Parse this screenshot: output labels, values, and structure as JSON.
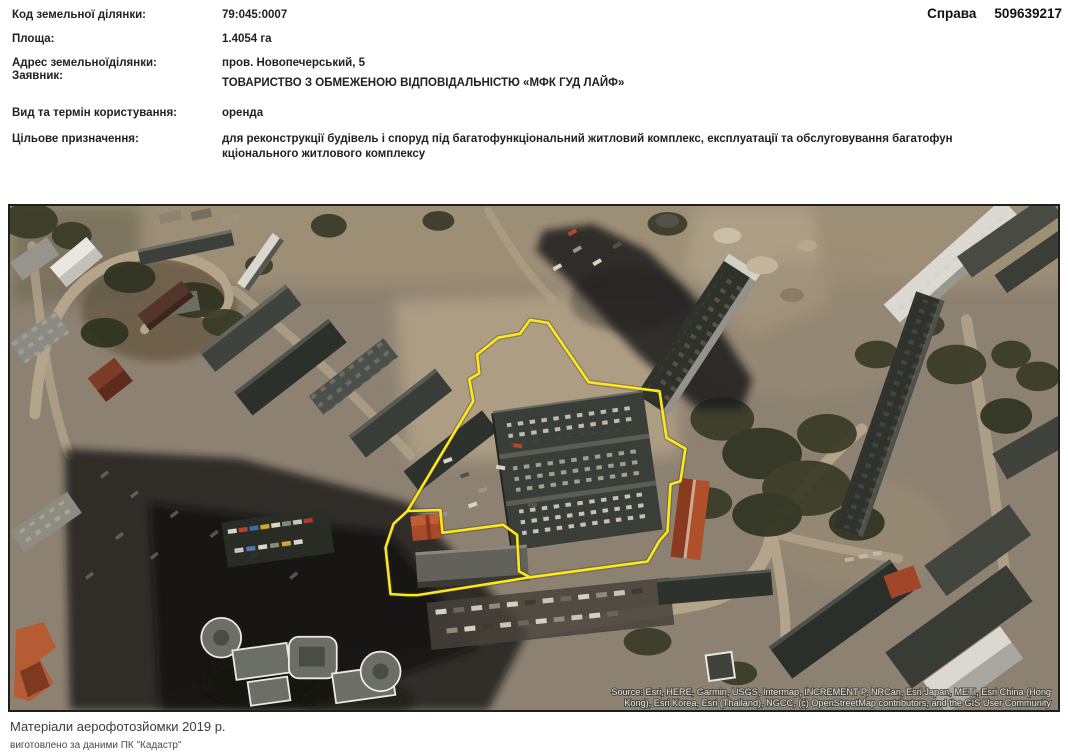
{
  "case": {
    "label": "Справа",
    "number": "509639217"
  },
  "fields": [
    {
      "label": "Код земельної ділянки:",
      "value": "79:045:0007"
    },
    {
      "label": "Площа:",
      "value": "1.4054 га"
    },
    {
      "label": "Адрес земельноїділянки:",
      "value": "пров. Новопечерський, 5"
    },
    {
      "label": "Заявник:",
      "value": "ТОВАРИСТВО З ОБМЕЖЕНОЮ ВІДПОВІДАЛЬНІСТЮ «МФК ГУД ЛАЙФ»"
    },
    {
      "label": "Вид та термін користування:",
      "value": "оренда"
    },
    {
      "label": "Цільове призначення:",
      "value_line1": "для реконструкції будівель і споруд під багатофункціональний житловий комплекс, експлуатації та обслуговування багатофун",
      "value_line2": "кціонального житлового комплексу"
    }
  ],
  "map": {
    "parcel_color": "#ffe81a",
    "attribution_line1": "Source: Esri, HERE, Garmin, USGS, Intermap, INCREMENT P, NRCan, Esri Japan, METI, Esri China (Hong",
    "attribution_line2": "Kong), Esri Korea, Esri (Thailand), NGCC, (c) OpenStreetMap contributors, and the GIS User Community"
  },
  "footer": {
    "line1": "Матеріали аерофотозйомки 2019 р.",
    "line2": "виготовлено за даними ПК \"Кадастр\""
  }
}
